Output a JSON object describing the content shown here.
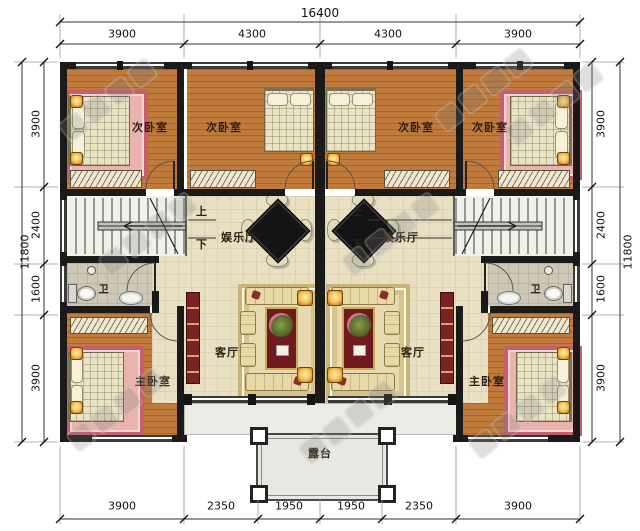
{
  "plan": {
    "rooms": {
      "secondary_bedroom": "次卧室",
      "master_bedroom": "主卧室",
      "living_room": "客厅",
      "recreation_hall": "娱乐厅",
      "bathroom": "卫",
      "terrace": "露台"
    },
    "stairs": {
      "up": "上",
      "down": "下"
    },
    "dimensions": {
      "top": {
        "overall": "16400",
        "segments": [
          "3900",
          "4300",
          "4300",
          "3900"
        ]
      },
      "bottom": {
        "segments": [
          "3900",
          "2350",
          "1950",
          "1950",
          "2350",
          "3900"
        ]
      },
      "left": {
        "overall": "11800",
        "segments": [
          "3900",
          "2400",
          "1600",
          "3900"
        ]
      },
      "right": {
        "overall": "11800",
        "segments": [
          "3900",
          "2400",
          "1600",
          "3900"
        ]
      }
    },
    "colors": {
      "wall": "#1a1a1a",
      "wood_floor": "#bf7a3c",
      "tile_floor": "#e9dfc3",
      "bath_floor": "#cfc7b5",
      "rug_pink": "#eab3ae",
      "rug_border": "#c4606e",
      "accent_red": "#7a2025",
      "lamp_glow": "#f3c04f",
      "terrace_floor": "#e6e8e2"
    }
  }
}
